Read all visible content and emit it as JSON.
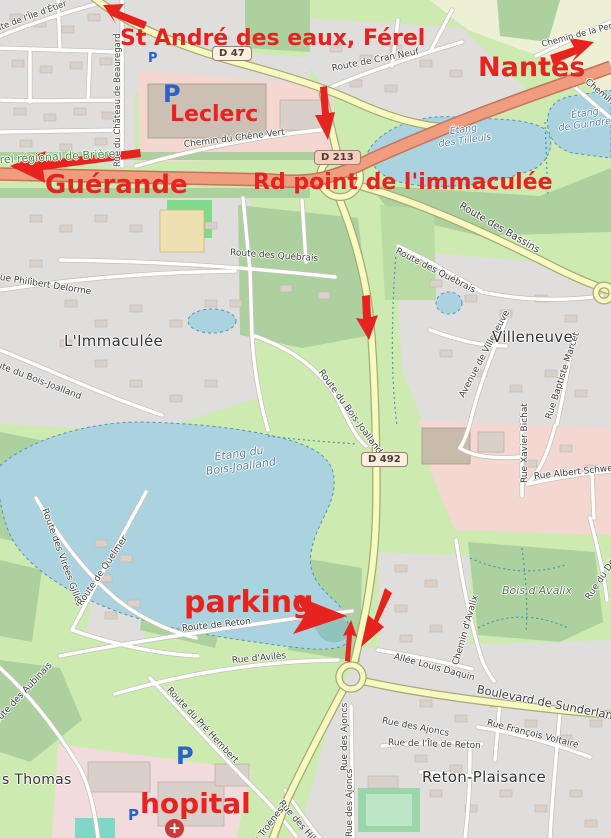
{
  "map": {
    "annotations": {
      "st_andre": "St André des eaux, Férel",
      "nantes": "Nantes",
      "guerande": "Guérande",
      "leclerc": "Leclerc",
      "rd_point": "Rd point de l'immaculée",
      "parking": "parking",
      "hopital": "hopital"
    },
    "badges": {
      "d47": "D 47",
      "d213": "D 213",
      "d492": "D 492"
    },
    "places": {
      "immaculee": "L'Immaculée",
      "villeneuve": "Villeneuve",
      "reton_plaisance": "Reton-Plaisance",
      "thomas": "s Thomas"
    },
    "water": {
      "bois_joalland": [
        "Étang du",
        "Bois-Joalland"
      ],
      "tilleuls": [
        "Étang",
        "des Tilleuls"
      ],
      "guindref": [
        "Étang",
        "de Guindref"
      ]
    },
    "green": {
      "briere": "Parc naturel régional de Brière",
      "bois_avalix": "Bois d'Avalix"
    },
    "streets": {
      "ile_detier": "Route de l'Île d'Étier",
      "chateau_beauregard": "Rue du Château de Beauregard",
      "cran_neuf": "Route de Cran Neuf",
      "chene_vert": "Chemin du Chêne Vert",
      "perriere": "Chemin de la Perrière",
      "chemin_2": "Chemin",
      "bassins": "Route des Bassins",
      "quebrais_1": "Route des Québrais",
      "quebrais_2": "Route des Québrais",
      "philibert_delorme": "Rue Philibert Delorme",
      "bois_joalland_1": "Route du Bois-Joalland",
      "bois_joalland_2": "Route du Bois-Joalland",
      "avenue_villeneuve": "Avenue de Villeneuve",
      "baptiste_marcet": "Rue Baptiste Marcet",
      "xavier_bichat": "Rue Xavier Bichat",
      "albert_schweitzer": "Rue Albert Schweitzer",
      "virees_gilles": "Route des Virées Gilles",
      "quelmer": "Route de Quelmer",
      "route_reton": "Route de Reton",
      "aviles": "Rue d'Avilès",
      "louis_daquin": "Allée Louis Daquin",
      "chemin_avalix": "Chemin d'Avalix",
      "rue_docteur": "Rue du Docteur",
      "sunderland": "Boulevard de Sunderland",
      "aubinais": "Route des Aubinais",
      "pre_hembert": "Route du Pré Hembert",
      "hibiscus": "Rue des Hibiscus",
      "ajoncs_1": "Rue des Ajoncs",
      "ajoncs_2": "Rue des Ajoncs",
      "ajoncs_3": "Rue des Ajoncs",
      "ile_reton": "Rue de l'Île de Reton",
      "francois_voltaire": "Rue François Voltaire",
      "troenes": "Rue des Troènes"
    },
    "icons": {
      "parking_letter": "P",
      "hospital_cross": "+"
    },
    "colors": {
      "annotation_red": "#e6231e",
      "water": "#aad3df",
      "wood": "#add19e",
      "grass": "#cdebb0",
      "residential": "#e0dedc",
      "trunk_road": "#ef9c7f",
      "secondary_road": "#f7fabf",
      "parking_blue": "#2a62c9"
    }
  }
}
